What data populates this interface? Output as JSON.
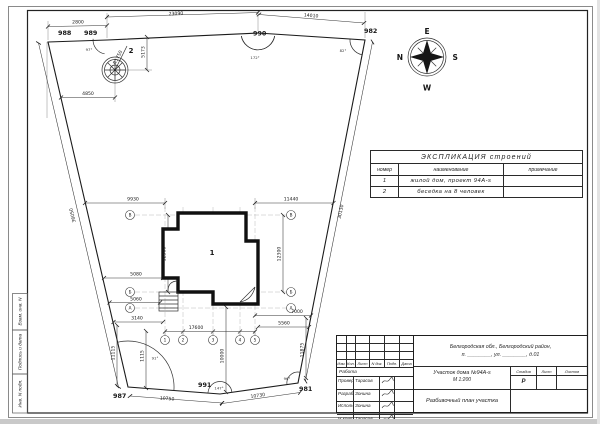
{
  "sheet": {
    "side_labels": {
      "top": "Взам. инв. N",
      "middle": "Подпись и дата",
      "bottom": "Инв. N подл."
    }
  },
  "compass": {
    "east": "E",
    "south": "S",
    "west": "W",
    "north": "N"
  },
  "plan": {
    "points": {
      "p988": "988",
      "p989": "989",
      "p990": "990",
      "p982": "982",
      "p981": "981",
      "p991": "991",
      "p987": "987"
    },
    "boundary_dims": {
      "d2800": "2800",
      "d23090": "23090",
      "d14010": "14010",
      "d36050": "36050",
      "d30130": "30130",
      "d10750": "10750",
      "d10730": "10730"
    },
    "angles": {
      "a989": "97°",
      "a990": "172°",
      "a982": "82°",
      "a987": "91°",
      "a991": "147°",
      "a981": "96°"
    },
    "gazebo": {
      "number": "2",
      "radius_label": "R1750",
      "dim_vertical": "5173",
      "dim_horizontal": "4850"
    },
    "house": {
      "number": "1"
    },
    "house_dims": {
      "d9930": "9930",
      "d11440": "11440",
      "d12300_left": "12300",
      "d12300_right": "12300",
      "d5080": "5080",
      "d5060": "5060",
      "d3140": "3140",
      "d17600": "17600",
      "d10000": "10000",
      "d11115": "11115",
      "d1115": "1115",
      "d7000": "7000",
      "d5560": "5560",
      "d11875": "11875"
    },
    "axes": {
      "left_top": "В",
      "left_mid": "Б",
      "left_bottom": "А",
      "right_top": "В",
      "right_mid": "Б",
      "right_bottom": "А",
      "b1": "1",
      "b2": "2",
      "b3": "3",
      "b4": "4",
      "b5": "5"
    }
  },
  "explication": {
    "title": "ЭКСПЛИКАЦИЯ строений",
    "headers": {
      "number": "номер",
      "name": "наименование",
      "note": "примечание"
    },
    "rows": [
      {
        "number": "1",
        "name": "жилой дом, проект 94А-s",
        "note": ""
      },
      {
        "number": "2",
        "name": "беседка на 8 человек",
        "note": ""
      }
    ]
  },
  "titleblock": {
    "header": {
      "izm": "Изм.",
      "kol": "Кол.",
      "list": "Лист",
      "ndoc": "N док.",
      "podp": "Подп.",
      "data": "Дата"
    },
    "work_row": "Работа",
    "roles": [
      {
        "role": "Провер.",
        "name": "Тарасов"
      },
      {
        "role": "Разраб.",
        "name": "Зонина"
      },
      {
        "role": "Исполнил",
        "name": "Зонина"
      },
      {
        "role": "Н.контр.",
        "name": "Тарасов"
      }
    ],
    "address_line1": "Белгородская обл., Белгородский район,",
    "address_line2": "п. ________, ул. ________, д.01",
    "object_line1": "Участок дома №94А-s",
    "object_line2": "М 1:200",
    "doc_title": "Разбивочный план участка",
    "stage": {
      "h_stadia": "Стадия",
      "h_list": "Лист",
      "h_listov": "Листов",
      "value": "Р"
    }
  }
}
